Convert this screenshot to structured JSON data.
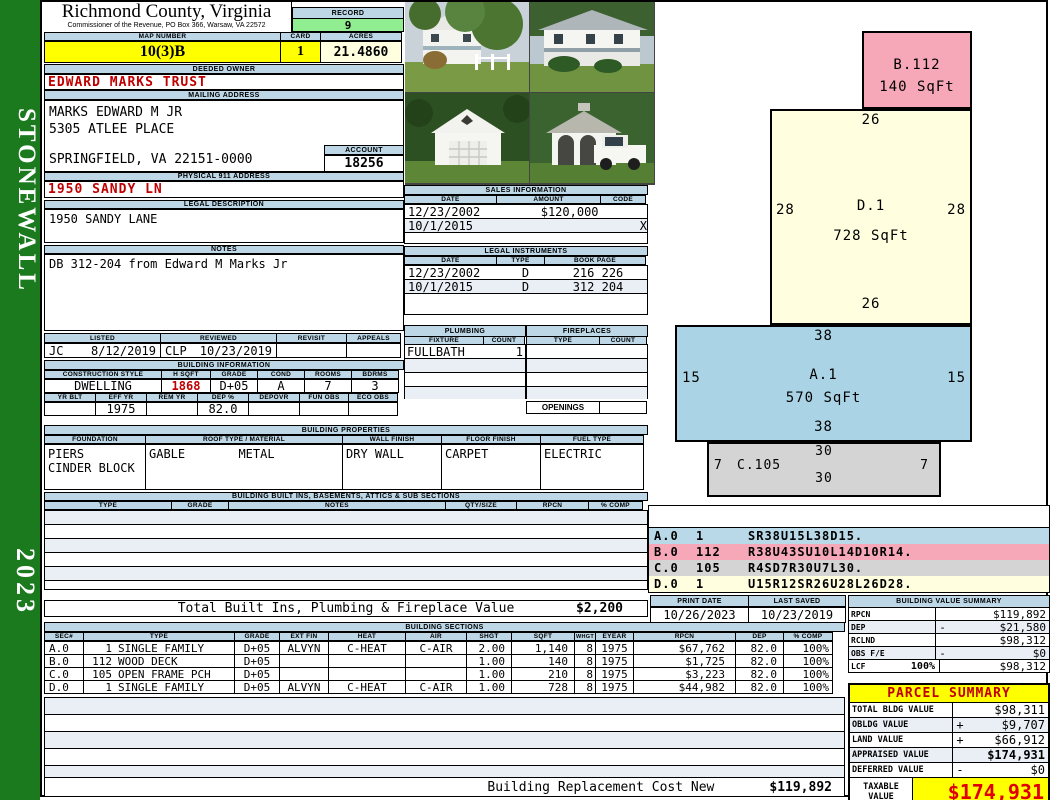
{
  "sidebar": {
    "district": "STONEWALL",
    "year": "2023"
  },
  "header": {
    "county": "Richmond County, Virginia",
    "office": "Commissioner of the Revenue, PO Box 366, Warsaw, VA 22572",
    "record_label": "RECORD",
    "record_value": "9",
    "map_number_label": "MAP NUMBER",
    "map_number_value": "10(3)B",
    "card_label": "CARD",
    "card_value": "1",
    "acres_label": "ACRES",
    "acres_value": "21.4860"
  },
  "owner": {
    "label": "DEEDED OWNER",
    "name": "EDWARD MARKS TRUST"
  },
  "mailing": {
    "label": "MAILING ADDRESS",
    "line1": "MARKS EDWARD M JR",
    "line2": "5305 ATLEE PLACE",
    "line3": "SPRINGFIELD, VA 22151-0000"
  },
  "account": {
    "label": "ACCOUNT",
    "value": "18256"
  },
  "physical_address": {
    "label": "PHYSICAL 911 ADDRESS",
    "value": "1950 SANDY LN"
  },
  "legal_description": {
    "label": "LEGAL DESCRIPTION",
    "value": "1950 SANDY LANE"
  },
  "notes": {
    "label": "NOTES",
    "value": "DB 312-204 from Edward M Marks Jr"
  },
  "visits": {
    "headers": [
      "LISTED",
      "REVIEWED",
      "REVISIT",
      "APPEALS"
    ],
    "listed_by": "JC",
    "listed_date": "8/12/2019",
    "reviewed_by": "CLP",
    "reviewed_date": "10/23/2019",
    "revisit": "",
    "appeals": ""
  },
  "building_information": {
    "title": "BUILDING INFORMATION",
    "row1_headers": [
      "CONSTRUCTION STYLE",
      "H SQFT",
      "GRADE",
      "COND",
      "ROOMS",
      "BDRMS"
    ],
    "row1_values": [
      "DWELLING",
      "1868",
      "D+05",
      "A",
      "7",
      "3"
    ],
    "row2_headers": [
      "YR BLT",
      "EFF YR",
      "REM YR",
      "DEP %",
      "DEPOVR",
      "FUN OBS",
      "ECO OBS"
    ],
    "row2_values": [
      "",
      "1975",
      "",
      "82.0",
      "",
      "",
      ""
    ]
  },
  "building_properties": {
    "title": "BUILDING PROPERTIES",
    "headers": [
      "FOUNDATION",
      "ROOF TYPE / MATERIAL",
      "WALL FINISH",
      "FLOOR FINISH",
      "FUEL TYPE"
    ],
    "foundation_line1": "PIERS",
    "foundation_line2": "CINDER BLOCK",
    "roof_type": "GABLE",
    "roof_material": "METAL",
    "wall_finish": "DRY WALL",
    "floor_finish": "CARPET",
    "fuel_type": "ELECTRIC"
  },
  "built_ins": {
    "title": "BUILDING BUILT INS, BASEMENTS, ATTICS & SUB SECTIONS",
    "headers": [
      "TYPE",
      "GRADE",
      "NOTES",
      "QTY/SIZE",
      "RPCN",
      "% COMP"
    ],
    "total_label": "Total Built Ins, Plumbing & Fireplace Value",
    "total_value": "$2,200"
  },
  "sales_information": {
    "title": "SALES INFORMATION",
    "headers": [
      "DATE",
      "AMOUNT",
      "CODE"
    ],
    "rows": [
      {
        "date": "12/23/2002",
        "amount": "$120,000",
        "code": ""
      },
      {
        "date": "10/1/2015",
        "amount": "",
        "code": "X"
      }
    ]
  },
  "legal_instruments": {
    "title": "LEGAL INSTRUMENTS",
    "headers": [
      "DATE",
      "TYPE",
      "BOOK PAGE"
    ],
    "rows": [
      {
        "date": "12/23/2002",
        "type": "D",
        "book_page": "216 226"
      },
      {
        "date": "10/1/2015",
        "type": "D",
        "book_page": "312 204"
      }
    ]
  },
  "plumbing": {
    "title": "PLUMBING",
    "headers": [
      "FIXTURE",
      "COUNT"
    ],
    "rows": [
      {
        "fixture": "FULLBATH",
        "count": "1"
      }
    ]
  },
  "fireplaces": {
    "title": "FIREPLACES",
    "headers": [
      "TYPE",
      "COUNT"
    ],
    "openings_label": "OPENINGS"
  },
  "sketch": {
    "sections": {
      "b": {
        "name": "B.112",
        "sqft": "140 SqFt",
        "color": "#f6a8b8"
      },
      "d": {
        "name": "D.1",
        "sqft": "728 SqFt",
        "dim_top": "26",
        "dim_left": "28",
        "dim_right": "28",
        "dim_bottom": "26",
        "color": "#ffffe0"
      },
      "a": {
        "name": "A.1",
        "sqft": "570 SqFt",
        "dim_top": "38",
        "dim_left": "15",
        "dim_right": "15",
        "dim_bottom": "38",
        "color": "#aad4e5"
      },
      "c": {
        "name": "C.105",
        "dim_top": "30",
        "dim_left": "7",
        "dim_right": "7",
        "dim_bottom": "30",
        "color": "#d4d4d4"
      }
    },
    "legend": [
      {
        "sec": "A.0",
        "num": "1",
        "path": "SR38U15L38D15."
      },
      {
        "sec": "B.0",
        "num": "112",
        "path": "R38U43SU10L14D10R14."
      },
      {
        "sec": "C.0",
        "num": "105",
        "path": "R4SD7R30U7L30."
      },
      {
        "sec": "D.0",
        "num": "1",
        "path": "U15R12SR26U28L26D28."
      }
    ]
  },
  "print_info": {
    "print_date_label": "PRINT DATE",
    "print_date": "10/26/2023",
    "last_saved_label": "LAST SAVED",
    "last_saved": "10/23/2019"
  },
  "building_value_summary": {
    "title": "BUILDING VALUE SUMMARY",
    "rows": [
      {
        "label": "RPCN",
        "pct": "",
        "sign": "",
        "value": "$119,892"
      },
      {
        "label": "DEP",
        "pct": "",
        "sign": "-",
        "value": "$21,580"
      },
      {
        "label": "RCLND",
        "pct": "",
        "sign": "",
        "value": "$98,312"
      },
      {
        "label": "OBS F/E",
        "pct": "",
        "sign": "-",
        "value": "$0"
      },
      {
        "label": "LCF",
        "pct": "100%",
        "sign": "",
        "value": "$98,312"
      }
    ]
  },
  "building_sections": {
    "title": "BUILDING SECTIONS",
    "headers": [
      "SEC#",
      "TYPE",
      "GRADE",
      "EXT FIN",
      "HEAT",
      "AIR",
      "SHGT",
      "SQFT",
      "WHGT",
      "EYEAR",
      "RPCN",
      "DEP",
      "% COMP"
    ],
    "rows": [
      {
        "sec": "A.0",
        "type_num": "1",
        "type_name": "SINGLE FAMILY",
        "grade": "D+05",
        "ext_fin": "ALVYN",
        "heat": "C-HEAT",
        "air": "C-AIR",
        "shgt": "2.00",
        "sqft": "1,140",
        "whgt": "8",
        "eyear": "1975",
        "rpcn": "$67,762",
        "dep": "82.0",
        "comp": "100%"
      },
      {
        "sec": "B.0",
        "type_num": "112",
        "type_name": "WOOD DECK",
        "grade": "D+05",
        "ext_fin": "",
        "heat": "",
        "air": "",
        "shgt": "1.00",
        "sqft": "140",
        "whgt": "8",
        "eyear": "1975",
        "rpcn": "$1,725",
        "dep": "82.0",
        "comp": "100%"
      },
      {
        "sec": "C.0",
        "type_num": "105",
        "type_name": "OPEN FRAME PCH",
        "grade": "D+05",
        "ext_fin": "",
        "heat": "",
        "air": "",
        "shgt": "1.00",
        "sqft": "210",
        "whgt": "8",
        "eyear": "1975",
        "rpcn": "$3,223",
        "dep": "82.0",
        "comp": "100%"
      },
      {
        "sec": "D.0",
        "type_num": "1",
        "type_name": "SINGLE FAMILY",
        "grade": "D+05",
        "ext_fin": "ALVYN",
        "heat": "C-HEAT",
        "air": "C-AIR",
        "shgt": "1.00",
        "sqft": "728",
        "whgt": "8",
        "eyear": "1975",
        "rpcn": "$44,982",
        "dep": "82.0",
        "comp": "100%"
      }
    ],
    "replacement_label": "Building Replacement Cost New",
    "replacement_value": "$119,892"
  },
  "parcel_summary": {
    "title": "PARCEL SUMMARY",
    "rows": [
      {
        "label": "TOTAL BLDG VALUE",
        "sign": "",
        "value": "$98,311"
      },
      {
        "label": "OBLDG VALUE",
        "sign": "+",
        "value": "$9,707"
      },
      {
        "label": "LAND VALUE",
        "sign": "+",
        "value": "$66,912"
      },
      {
        "label": "APPRAISED VALUE",
        "sign": "",
        "value": "$174,931"
      },
      {
        "label": "DEFERRED VALUE",
        "sign": "-",
        "value": "$0"
      }
    ],
    "taxable_label": "TAXABLE VALUE",
    "taxable_value": "$174,931"
  },
  "photos": {
    "items": [
      "house-front-left-view",
      "house-front-right-view",
      "garage-view",
      "gazebo-truck-view"
    ]
  },
  "colors": {
    "panel_header": "#bdd7e7",
    "highlight_yellow": "#ffff00",
    "record_green": "#90ee90",
    "cream": "#ffffe0",
    "sidebar_green": "#1b7a1e",
    "alert_red": "#c00000",
    "sketch_blue": "#aad4e5",
    "sketch_pink": "#f6a8b8",
    "sketch_gray": "#d4d4d4"
  }
}
